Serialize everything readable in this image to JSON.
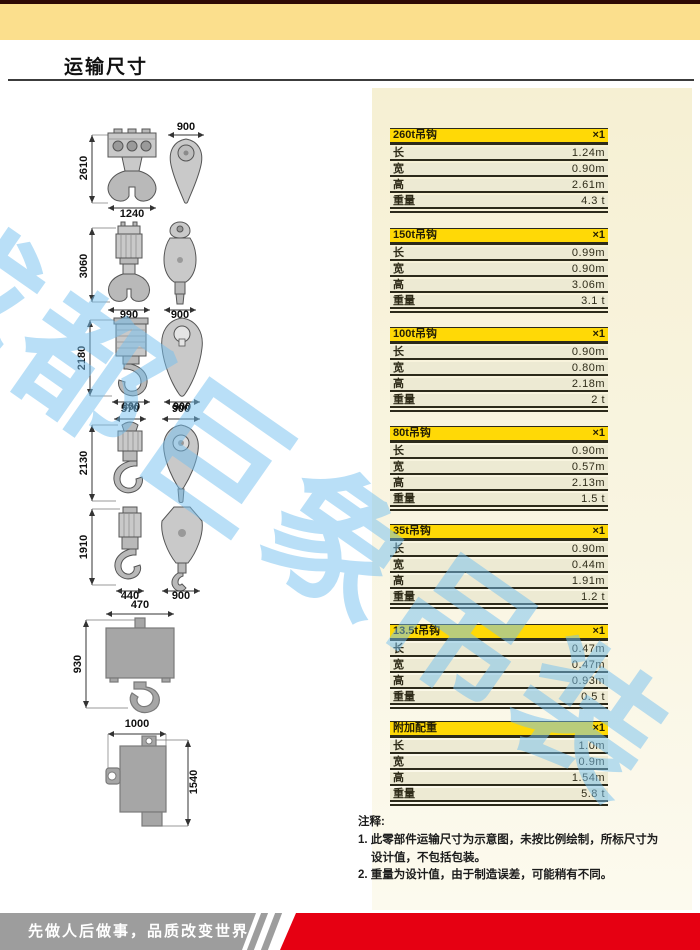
{
  "page": {
    "title": "运输尺寸"
  },
  "watermark": {
    "text": "成都巨象吊装"
  },
  "colors": {
    "band_yellow": "#fbdf8d",
    "table_header_yellow": "#ffd906",
    "table_row_cream": "#edead3",
    "top_maroon": "#2e0904",
    "footer_gray": "#9d9d9d",
    "footer_red": "#e60012",
    "watermark_blue": "#74c0f0"
  },
  "tables": [
    {
      "name": "260t吊钩",
      "qty": "×1",
      "rows": [
        {
          "label": "长",
          "value": "1.24m"
        },
        {
          "label": "宽",
          "value": "0.90m"
        },
        {
          "label": "高",
          "value": "2.61m"
        },
        {
          "label": "重量",
          "value": "4.3 t"
        }
      ]
    },
    {
      "name": "150t吊钩",
      "qty": "×1",
      "rows": [
        {
          "label": "长",
          "value": "0.99m"
        },
        {
          "label": "宽",
          "value": "0.90m"
        },
        {
          "label": "高",
          "value": "3.06m"
        },
        {
          "label": "重量",
          "value": "3.1 t"
        }
      ]
    },
    {
      "name": "100t吊钩",
      "qty": "×1",
      "rows": [
        {
          "label": "长",
          "value": "0.90m"
        },
        {
          "label": "宽",
          "value": "0.80m"
        },
        {
          "label": "高",
          "value": "2.18m"
        },
        {
          "label": "重量",
          "value": "2 t"
        }
      ]
    },
    {
      "name": "80t吊钩",
      "qty": "×1",
      "rows": [
        {
          "label": "长",
          "value": "0.90m"
        },
        {
          "label": "宽",
          "value": "0.57m"
        },
        {
          "label": "高",
          "value": "2.13m"
        },
        {
          "label": "重量",
          "value": "1.5 t"
        }
      ]
    },
    {
      "name": "35t吊钩",
      "qty": "×1",
      "rows": [
        {
          "label": "长",
          "value": "0.90m"
        },
        {
          "label": "宽",
          "value": "0.44m"
        },
        {
          "label": "高",
          "value": "1.91m"
        },
        {
          "label": "重量",
          "value": "1.2 t"
        }
      ]
    },
    {
      "name": "13.5t吊钩",
      "qty": "×1",
      "rows": [
        {
          "label": "长",
          "value": "0.47m"
        },
        {
          "label": "宽",
          "value": "0.47m"
        },
        {
          "label": "高",
          "value": "0.93m"
        },
        {
          "label": "重量",
          "value": "0.5 t"
        }
      ]
    },
    {
      "name": "附加配重",
      "qty": "×1",
      "rows": [
        {
          "label": "长",
          "value": "1.0m"
        },
        {
          "label": "宽",
          "value": "0.9m"
        },
        {
          "label": "高",
          "value": "1.54m"
        },
        {
          "label": "重量",
          "value": "5.8 t"
        }
      ]
    }
  ],
  "drawings": [
    {
      "height": "2610",
      "front_width": "1240",
      "side_width": "900"
    },
    {
      "height": "3060",
      "front_width": "990",
      "side_width": "900"
    },
    {
      "height": "2180",
      "front_width": "800",
      "side_width": "900"
    },
    {
      "height": "2130",
      "front_width": "570",
      "side_width": "900"
    },
    {
      "height": "1910",
      "front_width": "440",
      "side_width": "900"
    },
    {
      "height": "930",
      "front_width": "470"
    },
    {
      "height": "1540",
      "front_width": "1000"
    }
  ],
  "notes": {
    "title": "注释:",
    "items": [
      "1. 此零部件运输尺寸为示意图，未按比例绘制，所标尺寸为",
      "设计值，不包括包装。",
      "2. 重量为设计值，由于制造误差，可能稍有不同。"
    ]
  },
  "footer": {
    "slogan": "先做人后做事，品质改变世界"
  }
}
